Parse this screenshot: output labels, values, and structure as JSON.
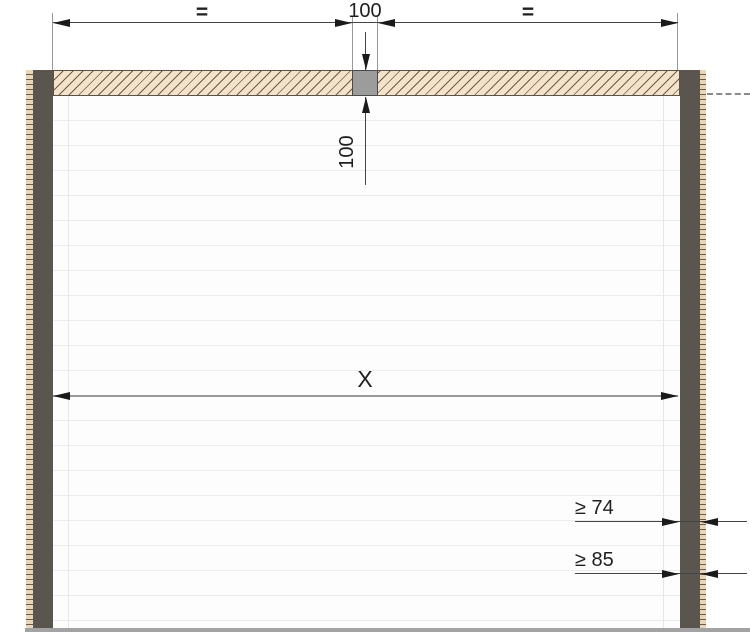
{
  "diagram": {
    "type": "technical-drawing",
    "subject": "garage-door-opening-front-view-with-lintel-side-frames-and-mounting-dimensions",
    "labels": {
      "top_left_segment": "=",
      "top_center_width": "100",
      "top_right_segment": "=",
      "lintel_height": "100",
      "clear_width": "X",
      "frame_depth_min_1": "≥ 74",
      "frame_depth_min_2": "≥ 85"
    },
    "colors": {
      "masonry_fill": "#f4e3ca",
      "masonry_edge": "#e9d6b8",
      "hatch_line": "#6a5c49",
      "post_fill": "#5a564f",
      "block_fill": "#9c9c9c",
      "dim_line": "#444444",
      "floor_line": "#a3a3a3",
      "panel_line": "#ececec"
    }
  }
}
